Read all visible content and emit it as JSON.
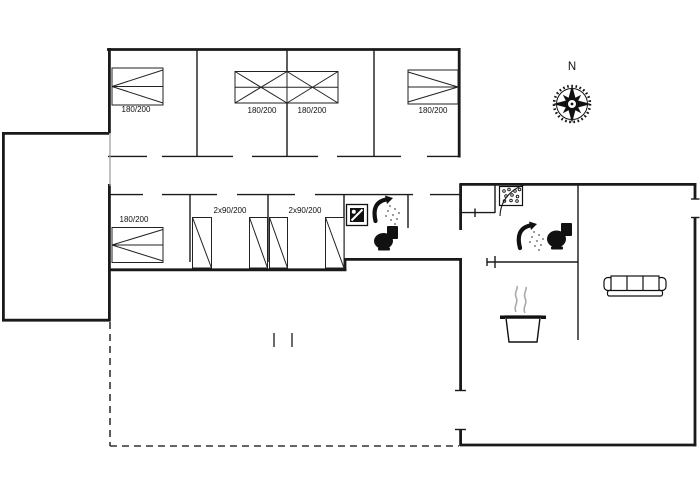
{
  "labels": {
    "bed_top_1": "180/200",
    "bed_top_2": "180/200",
    "bed_top_3": "180/200",
    "bed_top_4": "180/200",
    "bed_middle": "180/200",
    "bunk_room_1": "2x90/200",
    "bunk_room_2": "2x90/200",
    "compass_north": "N"
  },
  "icons": {
    "compass": "compass-rose-icon",
    "washing_machine": "washing-machine-icon",
    "shower": "shower-icon",
    "toilet": "toilet-icon",
    "whirlpool": "whirlpool-bubbles-icon",
    "cooking_pot": "cooking-pot-icon",
    "sofa": "sofa-icon"
  },
  "colors": {
    "background": "#ffffff",
    "walls": "#1a1a1a",
    "dashed_outline": "#333333",
    "light_line": "#999999",
    "steam": "#aaaaaa"
  }
}
